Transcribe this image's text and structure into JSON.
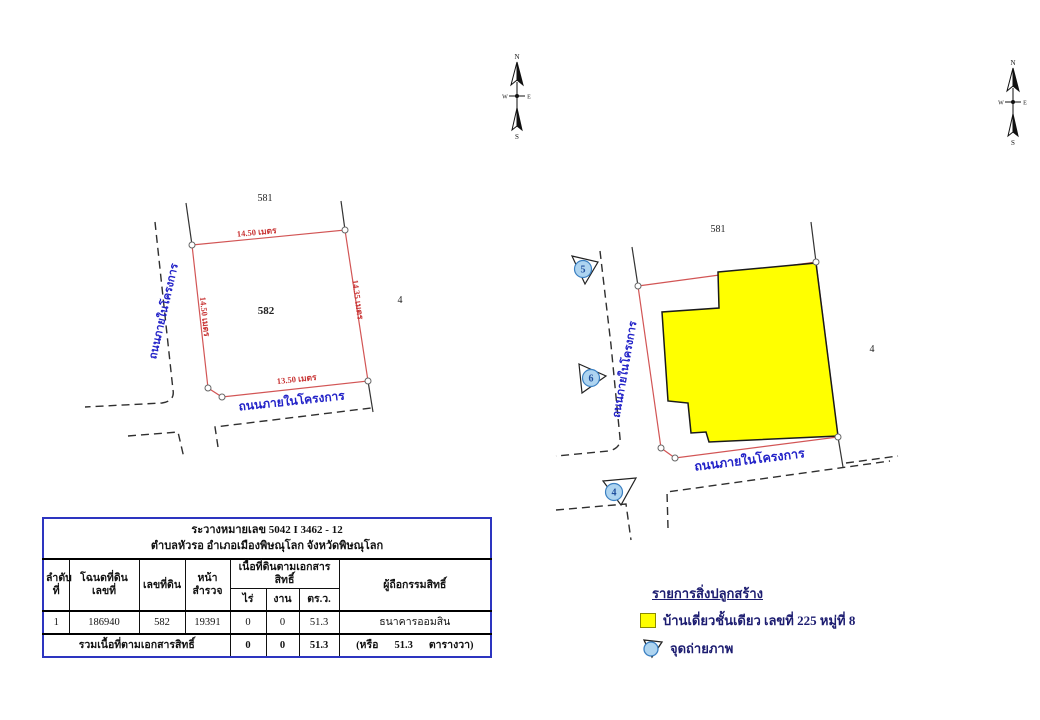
{
  "compass": {
    "n": "N",
    "s": "S",
    "w": "W",
    "e": "E"
  },
  "colors": {
    "boundary_red": "#d25555",
    "road_text_blue": "#2222c8",
    "dimension_red": "#c83232",
    "table_border_blue": "#2d35c0",
    "legend_text_navy": "#1c1c70",
    "building_yellow": "#ffff00",
    "photo_point_blue": "#aed4f0"
  },
  "diagram_left": {
    "parcel_north": "581",
    "parcel_main": "582",
    "parcel_east": "4",
    "dim_top": "14.50 เมตร",
    "dim_right": "14.35 เมตร",
    "dim_bottom": "13.50 เมตร",
    "dim_left": "14.50 เมตร",
    "road_left": "ถนนภายในโครงการ",
    "road_bottom": "ถนนภายในโครงการ"
  },
  "diagram_right": {
    "parcel_north": "581",
    "parcel_east": "4",
    "road_left": "ถนนภายในโครงการ",
    "road_bottom": "ถนนภายในโครงการ",
    "photo_points": [
      "5",
      "6",
      "4"
    ]
  },
  "table": {
    "title1": "ระวางหมายเลข 5042 I 3462 - 12",
    "title2": "ตำบลหัวรอ อำเภอเมืองพิษณุโลก จังหวัดพิษณุโลก",
    "headers": {
      "no1": "ลำดับ",
      "no2": "ที่",
      "deed1": "โฉนดที่ดิน",
      "deed2": "เลขที่",
      "parcel": "เลขที่ดิน",
      "survey": "หน้าสำรวจ",
      "area_group": "เนื้อที่ดินตามเอกสารสิทธิ์",
      "rai": "ไร่",
      "ngan": "งาน",
      "sqwah": "ตร.ว.",
      "owner": "ผู้ถือกรรมสิทธิ์"
    },
    "row": {
      "no": "1",
      "deed": "186940",
      "parcel": "582",
      "survey": "19391",
      "rai": "0",
      "ngan": "0",
      "sqwah": "51.3",
      "owner": "ธนาคารออมสิน"
    },
    "footer": {
      "label": "รวมเนื้อที่ตามเอกสารสิทธิ์",
      "rai": "0",
      "ngan": "0",
      "sqwah": "51.3",
      "note_open": "(หรือ",
      "note_value": "51.3",
      "note_close": "ตารางวา)"
    }
  },
  "legend": {
    "heading": "รายการสิ่งปลูกสร้าง",
    "building_label": "บ้านเดี่ยวชั้นเดียว เลขที่ 225 หมู่ที่ 8",
    "photo_label": "จุดถ่ายภาพ",
    "building_color": "#ffff00"
  }
}
